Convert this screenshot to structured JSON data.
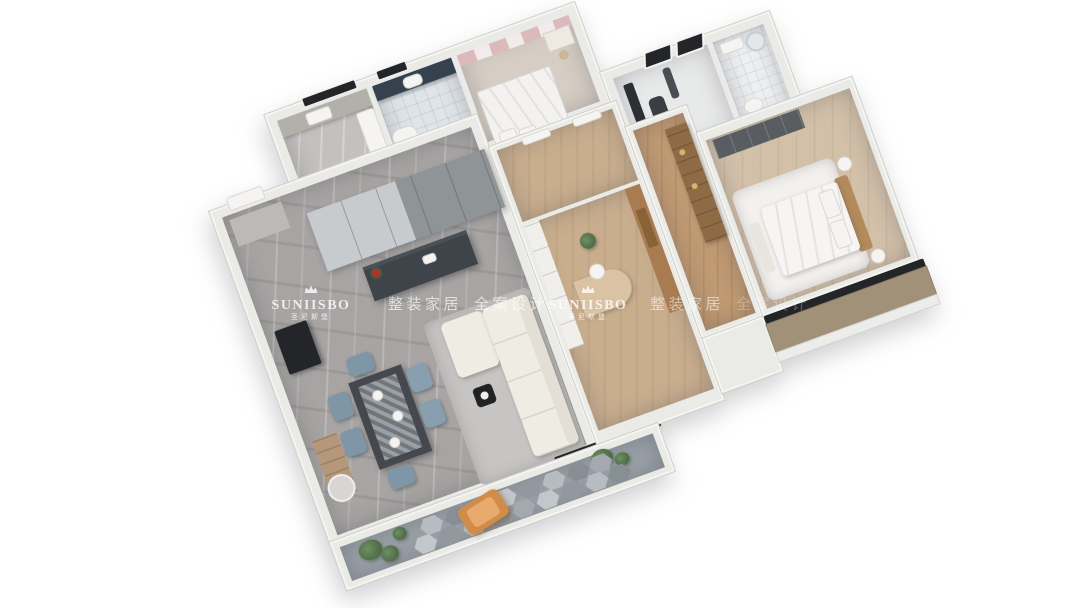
{
  "scene": {
    "description": "3D isometric dollhouse render of an apartment floor plan on white background",
    "rooms": [
      "entry",
      "living-room",
      "dining-area",
      "kitchen",
      "bathroom",
      "second-bedroom",
      "study-gym",
      "ensuite-bathroom",
      "hallway",
      "study-room",
      "wardrobe-corridor",
      "master-bedroom",
      "bay-window-ledge",
      "balcony"
    ]
  },
  "watermarks": {
    "brand": "SUNIISBO",
    "brand_cn": "圣尼斯堡",
    "tagline_1": "整装家居",
    "tagline_2": "全案设计",
    "color": "#ffffff",
    "crown_icon": "crown-icon"
  },
  "palette": {
    "background": "#ffffff",
    "wall": "#eaeae7",
    "living_marble_floor": "#a7a4a3",
    "wood_floor": "#c9ae8e",
    "bath_tile": "#dfe4e8",
    "closet_panels": "#9ca2a6",
    "sofa": "#efece4",
    "dining_chair": "#7e96a6",
    "dining_table": "#45494f",
    "kitchen_island": "#3f444a",
    "bedroom_curtain": "#dcb9ba",
    "bed_linen": "#f6f5f3",
    "headboard": "#b28a5c",
    "balcony_lounger": "#d18c49",
    "plants": "#5d7a52",
    "bay_ledge": "#a29179",
    "window_glass": "#1f2022"
  }
}
